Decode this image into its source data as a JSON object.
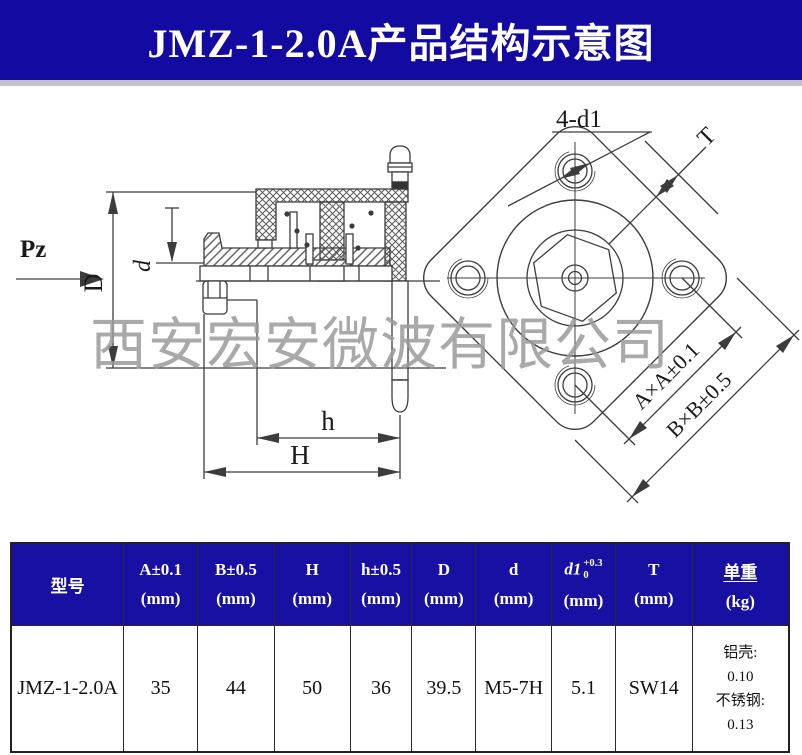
{
  "title": "JMZ-1-2.0A产品结构示意图",
  "watermark": "西安宏安微波有限公司",
  "colors": {
    "banner_blue": "#130aa1",
    "table_header_blue": "#1710a2",
    "drawing_line": "#3c3c3c",
    "watermark_gray": "#9b9b9b",
    "header_text": "#ffffff"
  },
  "drawing": {
    "labels": {
      "pz": "Pz",
      "dim_D": "D",
      "dim_d": "d",
      "dim_h": "h",
      "dim_H": "H",
      "holes": "4-d1",
      "dim_T": "T",
      "dim_A": "A×A±0.1",
      "dim_B": "B×B±0.5"
    }
  },
  "table": {
    "headers": [
      {
        "l1": "型号",
        "l2": ""
      },
      {
        "l1": "A±0.1",
        "l2": "(mm)"
      },
      {
        "l1": "B±0.5",
        "l2": "(mm)"
      },
      {
        "l1": "H",
        "l2": "(mm)"
      },
      {
        "l1": "h±0.5",
        "l2": "(mm)"
      },
      {
        "l1": "D",
        "l2": "(mm)"
      },
      {
        "l1": "d",
        "l2": "(mm)"
      },
      {
        "l1": "d1",
        "sup": "+0.3",
        "sub": "0",
        "l2": "(mm)"
      },
      {
        "l1": "T",
        "l2": "(mm)"
      },
      {
        "l1": "单重",
        "l2": "(kg)"
      }
    ],
    "row": {
      "model": "JMZ-1-2.0A",
      "A": "35",
      "B": "44",
      "H": "50",
      "h": "36",
      "D": "39.5",
      "d": "M5-7H",
      "d1": "5.1",
      "T": "SW14",
      "weight": {
        "w1": "铝壳:",
        "w2": "0.10",
        "w3": "不锈钢:",
        "w4": "0.13"
      }
    }
  }
}
